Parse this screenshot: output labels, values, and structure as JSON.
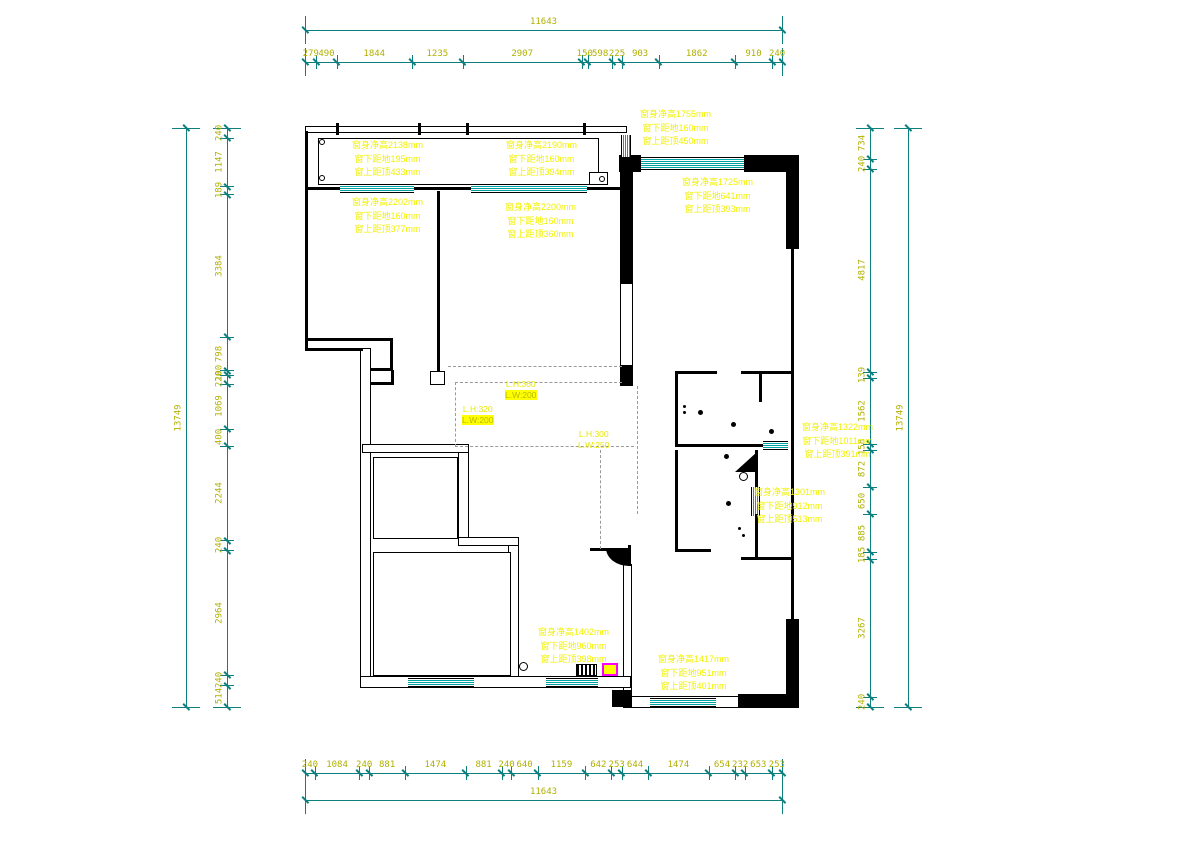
{
  "drawing": {
    "type": "residential floor plan with window and beam annotations",
    "unit": "mm",
    "colors": {
      "wall": "#000000",
      "window": "#00a2a2",
      "dimension_line": "#0e7f7f",
      "dimension_text": "#b0b000",
      "annotation_text": "#f2f200",
      "selection_highlight_border": "#ff00ff",
      "selection_highlight_fill": "#ffff00"
    },
    "dimensions": {
      "top": {
        "overall": "11643",
        "segments": [
          "279",
          "490",
          "1844",
          "1235",
          "2907",
          "150",
          "598",
          "225",
          "903",
          "1862",
          "910",
          "240"
        ]
      },
      "bottom": {
        "overall": "11643",
        "segments": [
          "240",
          "1084",
          "240",
          "881",
          "1474",
          "881",
          "240",
          "640",
          "1159",
          "642",
          "253",
          "644",
          "1474",
          "654",
          "232",
          "653",
          "253"
        ]
      },
      "left": {
        "overall": "13749",
        "segments": [
          "240",
          "1147",
          "189",
          "3384",
          "798",
          "100",
          "220",
          "1069",
          "400",
          "2244",
          "240",
          "2964",
          "240",
          "514"
        ]
      },
      "right": {
        "overall": "13749",
        "segments": [
          "734",
          "240",
          "4817",
          "139",
          "1562",
          "158",
          "872",
          "650",
          "885",
          "185",
          "3267",
          "240"
        ]
      }
    },
    "window_annotations": [
      {
        "lines": [
          "窗身净高2138mm",
          "窗下距地195mm",
          "窗上距顶433mm"
        ]
      },
      {
        "lines": [
          "窗身净高2190mm",
          "窗下距地160mm",
          "窗上距顶394mm"
        ]
      },
      {
        "lines": [
          "窗身净高1755mm",
          "窗下距地160mm",
          "窗上距顶450mm"
        ]
      },
      {
        "lines": [
          "窗身净高1725mm",
          "窗下距地641mm",
          "窗上距顶393mm"
        ]
      },
      {
        "lines": [
          "窗身净高2202mm",
          "窗下距地160mm",
          "窗上距顶377mm"
        ]
      },
      {
        "lines": [
          "窗身净高2200mm",
          "窗下距地160mm",
          "窗上距顶360mm"
        ]
      },
      {
        "lines": [
          "窗身净高1322mm",
          "窗下距地1011mm",
          "窗上距顶391mm"
        ]
      },
      {
        "lines": [
          "窗身净高1301mm",
          "窗下距地912mm",
          "窗上距顶513mm"
        ]
      },
      {
        "lines": [
          "窗身净高1402mm",
          "窗下距地960mm",
          "窗上距顶398mm"
        ]
      },
      {
        "lines": [
          "窗身净高1417mm",
          "窗下距地951mm",
          "窗上距顶401mm"
        ]
      }
    ],
    "beam_annotations": [
      {
        "lines": [
          "L.H:360",
          "L.W:200"
        ],
        "highlighted_line": 1
      },
      {
        "lines": [
          "L.H:320",
          "L.W:200"
        ],
        "highlighted_line": 1
      },
      {
        "lines": [
          "L.H:300",
          "L.W:250"
        ],
        "highlighted_line": -1
      }
    ]
  }
}
